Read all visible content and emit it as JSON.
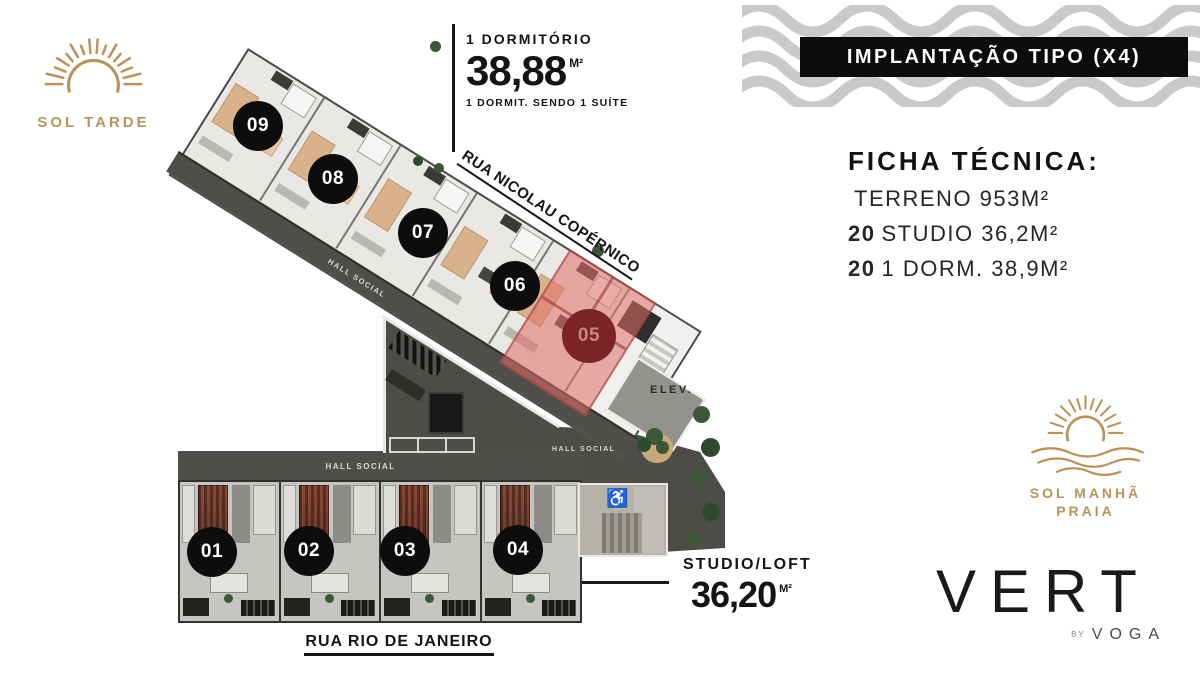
{
  "branding": {
    "sol_tarde": {
      "label": "SOL TARDE"
    },
    "sol_manha": {
      "line1": "SOL MANHÃ",
      "line2": "PRAIA"
    },
    "vert": {
      "name": "VERT",
      "by_label": "BY",
      "by_brand": "VOGA"
    }
  },
  "banner": {
    "title": "IMPLANTAÇÃO TIPO (X4)"
  },
  "info_1dorm": {
    "type": "1 DORMITÓRIO",
    "area": "38,88",
    "unit": "M²",
    "note": "1 DORMIT. SENDO 1 SUÍTE"
  },
  "info_studio": {
    "type": "STUDIO/LOFT",
    "area": "36,20",
    "unit": "M²"
  },
  "ficha": {
    "title": "FICHA TÉCNICA:",
    "rows": [
      {
        "qty": "",
        "text": "TERRENO 953M²"
      },
      {
        "qty": "20",
        "text": "STUDIO 36,2M²"
      },
      {
        "qty": "20",
        "text": "1 DORM. 38,9M²"
      }
    ]
  },
  "streets": {
    "north": "RUA NICOLAU COPÉRNICO",
    "south": "RUA RIO DE JANEIRO"
  },
  "plan": {
    "circles": [
      "09",
      "08",
      "07",
      "06",
      "05",
      "01",
      "02",
      "03",
      "04"
    ],
    "highlighted_unit": "05",
    "halls": [
      "HALL SOCIAL",
      "HALL SOCIAL",
      "HALL SOCIAL"
    ],
    "elevator": "ELEV.",
    "accessible_icon": "♿"
  },
  "colors": {
    "gold": "#b9935a",
    "highlight": "#e06f67",
    "highlight_circle": "#7b2428",
    "marker": "#0d0d0d",
    "wave_gray": "#c9c9c9"
  }
}
